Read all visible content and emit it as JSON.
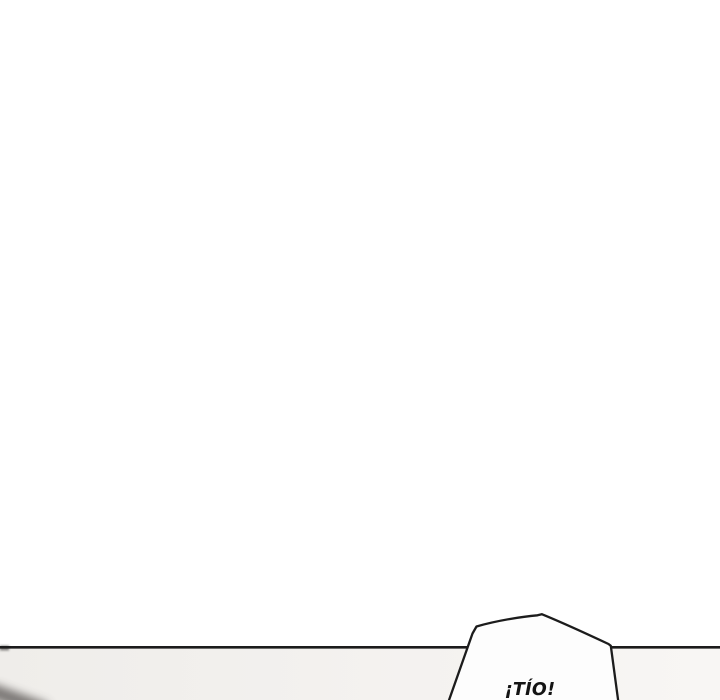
{
  "comic": {
    "panel": {
      "speech_bubble": {
        "text": "¡TÍO!"
      }
    },
    "colors": {
      "page_background": "#ffffff",
      "panel_border": "#1c1c1c",
      "next_panel_left": "#efedea",
      "next_panel_right": "#f8f6f4",
      "bubble_fill": "#fdfdfd",
      "bubble_stroke": "#1c1c1c",
      "lettering": "#141414",
      "corner_shadow": "#4f4b48"
    }
  }
}
